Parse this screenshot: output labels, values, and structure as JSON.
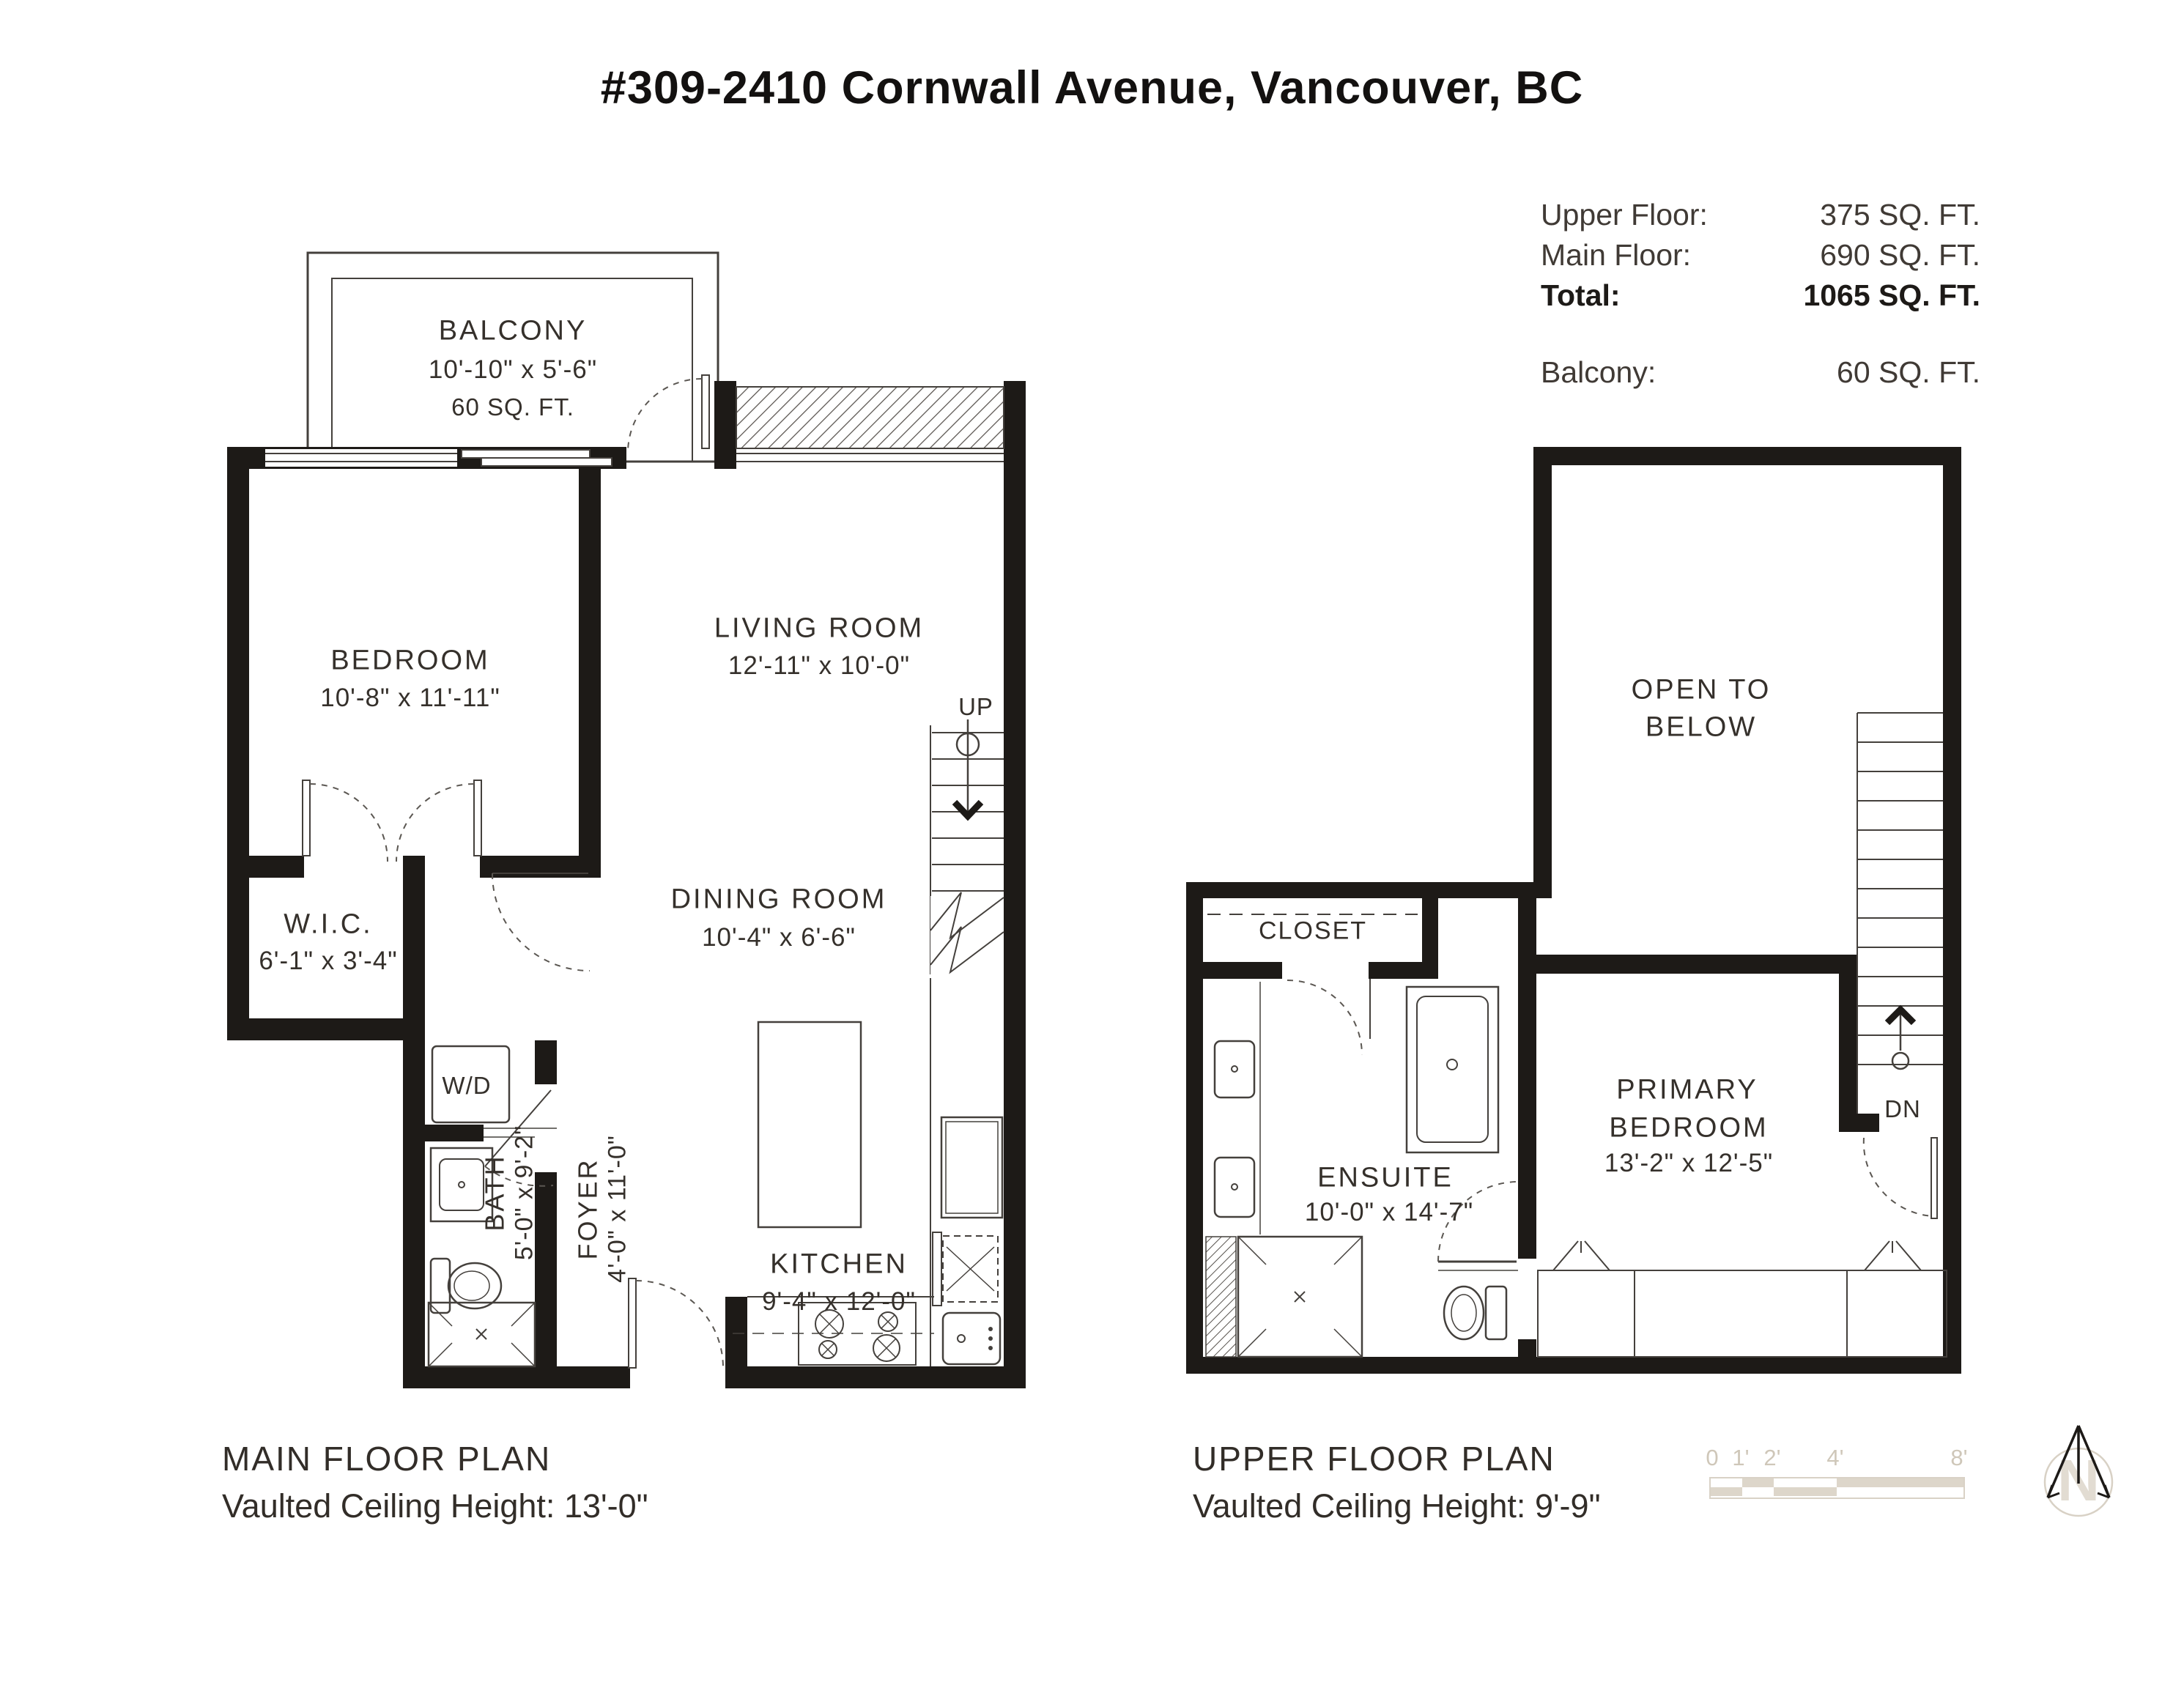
{
  "title": "#309-2410 Cornwall Avenue, Vancouver, BC",
  "summary": {
    "upper_label": "Upper Floor:",
    "upper_value": "375 SQ. FT.",
    "main_label": "Main Floor:",
    "main_value": "690 SQ. FT.",
    "total_label": "Total:",
    "total_value": "1065 SQ. FT.",
    "balcony_label": "Balcony:",
    "balcony_value": "60 SQ. FT."
  },
  "main_floor": {
    "caption": "MAIN FLOOR PLAN",
    "ceiling": "Vaulted Ceiling Height: 13'-0\"",
    "balcony_name": "BALCONY",
    "balcony_dims": "10'-10\" x 5'-6\"",
    "balcony_area": "60 SQ. FT.",
    "bedroom_name": "BEDROOM",
    "bedroom_dims": "10'-8\" x 11'-11\"",
    "living_name": "LIVING ROOM",
    "living_dims": "12'-11\" x 10'-0\"",
    "dining_name": "DINING ROOM",
    "dining_dims": "10'-4\" x 6'-6\"",
    "wic_name": "W.I.C.",
    "wic_dims": "6'-1\" x 3'-4\"",
    "bath_name": "BATH",
    "bath_dims": "5'-0\" x 9'-2\"",
    "foyer_name": "FOYER",
    "foyer_dims": "4'-0\" x 11'-0\"",
    "kitchen_name": "KITCHEN",
    "kitchen_dims": "9'-4\" x 12'-0\"",
    "wd": "W/D",
    "up": "UP"
  },
  "upper_floor": {
    "caption": "UPPER FLOOR PLAN",
    "ceiling": "Vaulted Ceiling Height: 9'-9\"",
    "open_line1": "OPEN TO",
    "open_line2": "BELOW",
    "closet": "CLOSET",
    "ensuite_name": "ENSUITE",
    "ensuite_dims": "10'-0\" x 14'-7\"",
    "primary_line1": "PRIMARY",
    "primary_line2": "BEDROOM",
    "primary_dims": "13'-2\" x 12'-5\"",
    "dn": "DN"
  },
  "scale_bar": {
    "t0": "0",
    "t1": "1'",
    "t2": "2'",
    "t3": "4'",
    "t4": "8'"
  },
  "compass": {
    "n": "N"
  },
  "colors": {
    "wall": "#1d1a17",
    "text": "#35302b",
    "muted_beige": "#ddd6ca",
    "label_beige": "#cfc7b9"
  }
}
